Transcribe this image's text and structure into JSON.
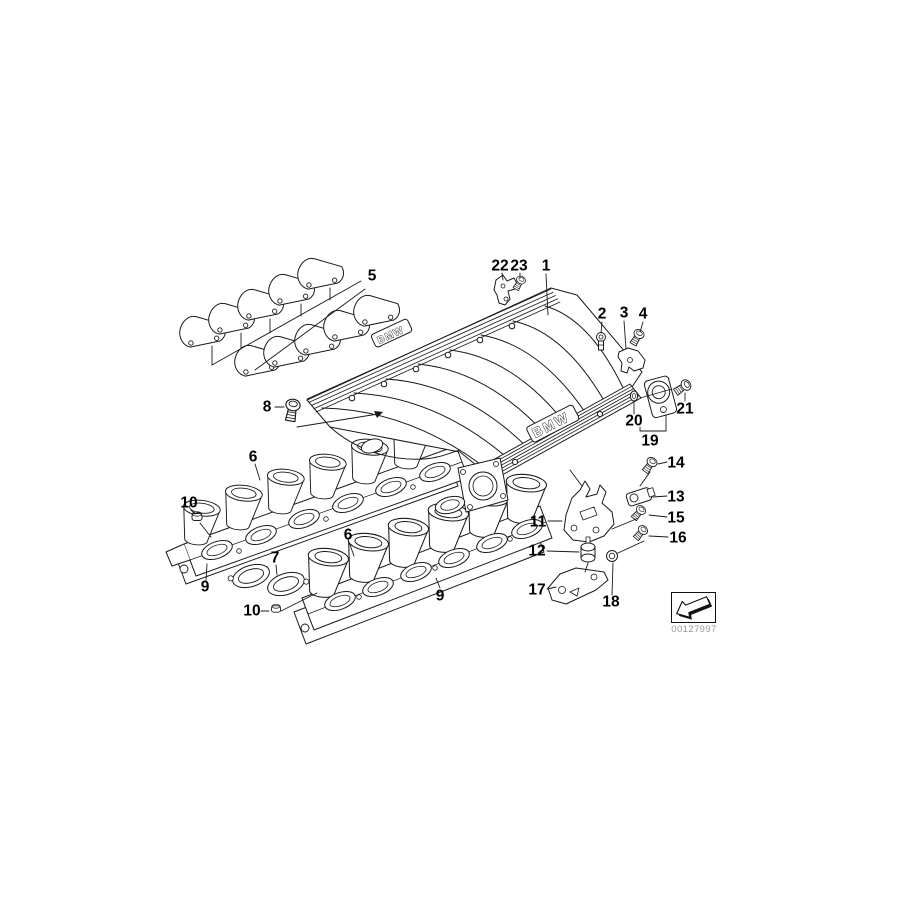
{
  "colors": {
    "background": "#ffffff",
    "line": "#1a1a1a",
    "label": "#000000",
    "stamp_text": "#9a9a9a"
  },
  "manifold_markings": {
    "brand_upper": "BMW",
    "brand_lower": "BMW"
  },
  "stamp": {
    "code": "00127997",
    "icon": "corner-arrow-icon"
  },
  "callouts": [
    {
      "id": "22",
      "label": "22",
      "x": 500,
      "y": 266
    },
    {
      "id": "23",
      "label": "23",
      "x": 519,
      "y": 266
    },
    {
      "id": "1",
      "label": "1",
      "x": 546,
      "y": 266
    },
    {
      "id": "2",
      "label": "2",
      "x": 602,
      "y": 314
    },
    {
      "id": "3",
      "label": "3",
      "x": 624,
      "y": 313
    },
    {
      "id": "4",
      "label": "4",
      "x": 643,
      "y": 314
    },
    {
      "id": "5",
      "label": "5",
      "x": 372,
      "y": 276
    },
    {
      "id": "8",
      "label": "8",
      "x": 267,
      "y": 407
    },
    {
      "id": "6a",
      "label": "6",
      "x": 253,
      "y": 457
    },
    {
      "id": "10a",
      "label": "10",
      "x": 189,
      "y": 503
    },
    {
      "id": "9a",
      "label": "9",
      "x": 205,
      "y": 587
    },
    {
      "id": "7",
      "label": "7",
      "x": 275,
      "y": 558
    },
    {
      "id": "10b",
      "label": "10",
      "x": 252,
      "y": 611
    },
    {
      "id": "6b",
      "label": "6",
      "x": 348,
      "y": 535
    },
    {
      "id": "9b",
      "label": "9",
      "x": 440,
      "y": 596
    },
    {
      "id": "11",
      "label": "11",
      "x": 538,
      "y": 522
    },
    {
      "id": "12",
      "label": "12",
      "x": 537,
      "y": 551
    },
    {
      "id": "17",
      "label": "17",
      "x": 537,
      "y": 590
    },
    {
      "id": "18",
      "label": "18",
      "x": 611,
      "y": 602
    },
    {
      "id": "14",
      "label": "14",
      "x": 676,
      "y": 463
    },
    {
      "id": "13",
      "label": "13",
      "x": 676,
      "y": 497
    },
    {
      "id": "15",
      "label": "15",
      "x": 676,
      "y": 518
    },
    {
      "id": "16",
      "label": "16",
      "x": 678,
      "y": 538
    },
    {
      "id": "20",
      "label": "20",
      "x": 634,
      "y": 421
    },
    {
      "id": "19",
      "label": "19",
      "x": 650,
      "y": 441
    },
    {
      "id": "21",
      "label": "21",
      "x": 685,
      "y": 409
    }
  ]
}
